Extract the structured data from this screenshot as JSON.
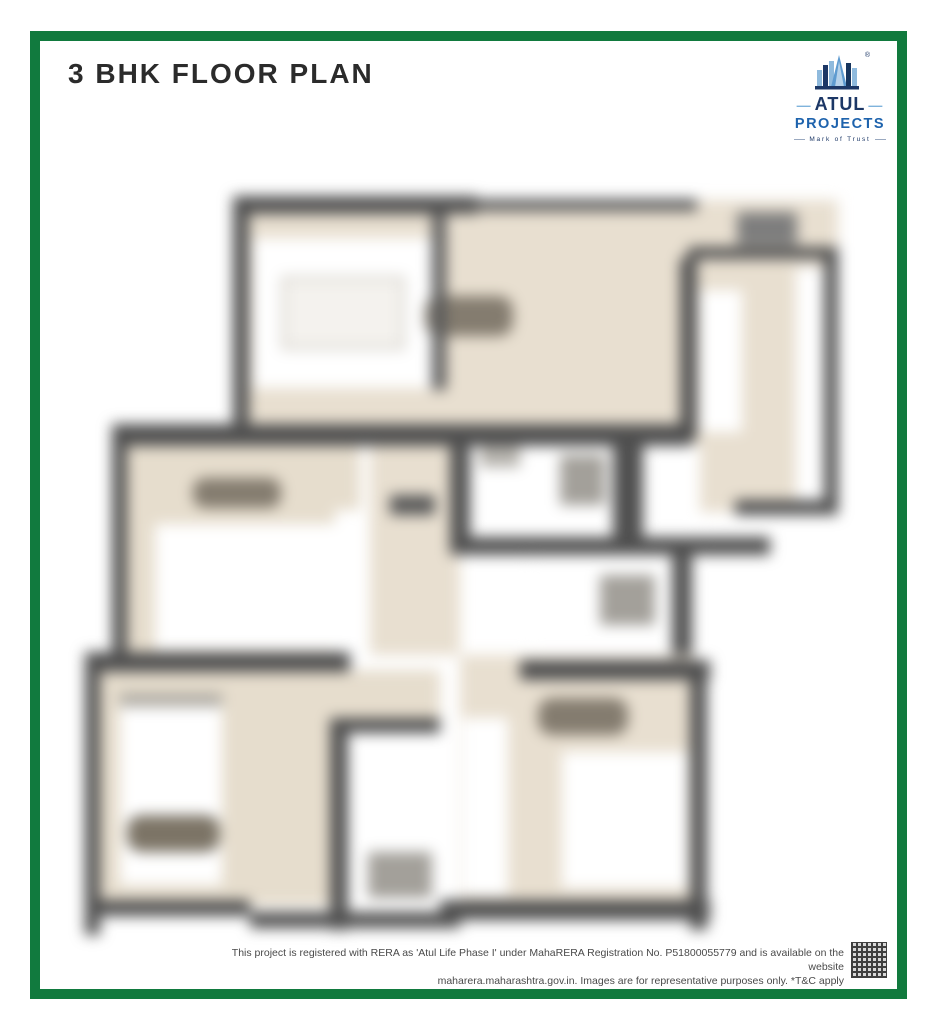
{
  "header": {
    "title": "3 BHK FLOOR PLAN"
  },
  "logo": {
    "brand": "ATUL",
    "dash": "—",
    "sub": "PROJECTS",
    "tagline": "Mark of Trust",
    "registered_mark": "®"
  },
  "floor_plan": {
    "label": "3 BHK floor plan drawing (blurred)",
    "colors": {
      "floor_beige": "#e8dfd0",
      "wall_dark": "#4f4f4f",
      "room_white": "#ffffff",
      "fixture_gray": "#a3a09a",
      "furniture_smudge": "#847c6f"
    }
  },
  "footer": {
    "line1": "This project is registered with RERA as 'Atul Life Phase I' under MahaRERA Registration No. P51800055779 and is available on the website",
    "line2": "maharera.maharashtra.gov.in. Images are for representative purposes only. *T&C apply"
  },
  "theme": {
    "frame_green": "#117a3e",
    "brand_navy": "#1c3766",
    "brand_blue": "#1e63ad",
    "brand_light_blue": "#7fb3dc",
    "title_color": "#2b2b2b",
    "footer_text_color": "#4a4a4a"
  }
}
